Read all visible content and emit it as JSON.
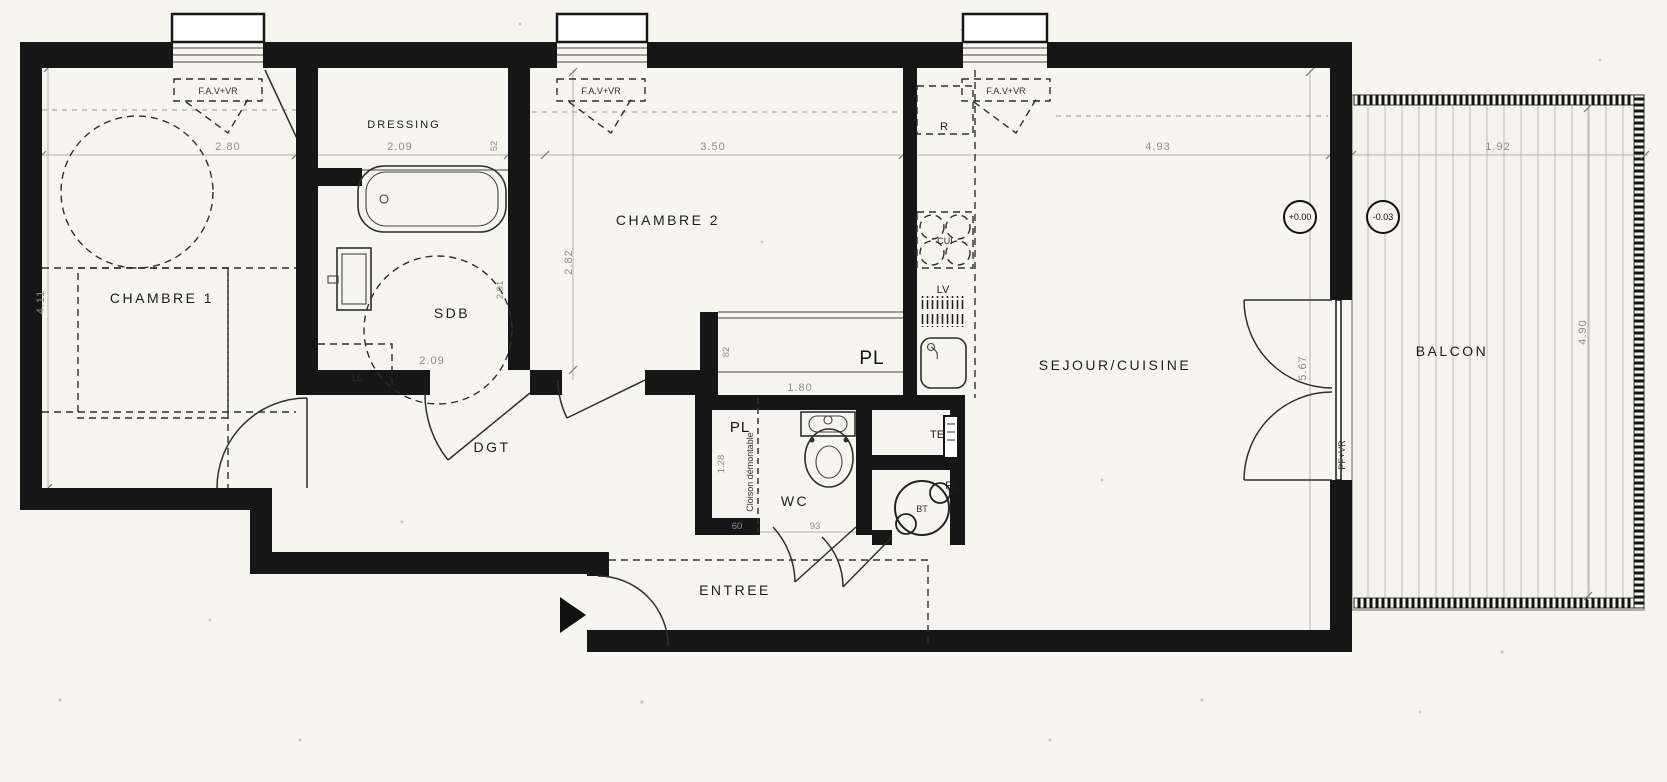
{
  "plan": {
    "rooms": {
      "chambre1": "CHAMBRE 1",
      "dressing": "DRESSING",
      "sdb": "SDB",
      "chambre2": "CHAMBRE 2",
      "dgt": "DGT",
      "wc": "WC",
      "entree": "ENTREE",
      "sejour": "SEJOUR/CUISINE",
      "balcon": "BALCON"
    },
    "closets": {
      "chambre2_placard": "PL",
      "entree_placard": "PL",
      "bt_placard": "PL"
    },
    "equipment": {
      "fridge": "R",
      "hob": "CUI",
      "dishwasher": "LV",
      "washer": "LL",
      "electrical_panel": "TE",
      "water_heater": "BT",
      "partition_note": "Cloison démontable"
    },
    "windows": {
      "w1": "F.A.V+VR",
      "w2": "F.A.V+VR",
      "w3": "F.A.V+VR",
      "balcony_door": "PF+VR"
    },
    "levels": {
      "interior": "+0.00",
      "balcony": "-0.03"
    },
    "dims": {
      "chambre1_w": "2.80",
      "chambre1_d": "4.11",
      "dressing_w": "2.09",
      "dressing_gap": "52",
      "chambre2_w": "3.50",
      "chambre2_d": "2.82",
      "sdb_w": "2.09",
      "sdb_d": "2.01",
      "sejour_w": "4.93",
      "sejour_d": "5.67",
      "placard_w": "1.80",
      "placard_d": "82",
      "entree_pl_w": "60",
      "entree_pl_d": "1.28",
      "wc_w": "93",
      "balcon_w": "1.92",
      "balcon_d": "4.90"
    },
    "colors": {
      "paper": "#f6f5ef",
      "wall": "#161616",
      "dim_text": "#8e8c85",
      "line": "#2e2e2c"
    }
  }
}
